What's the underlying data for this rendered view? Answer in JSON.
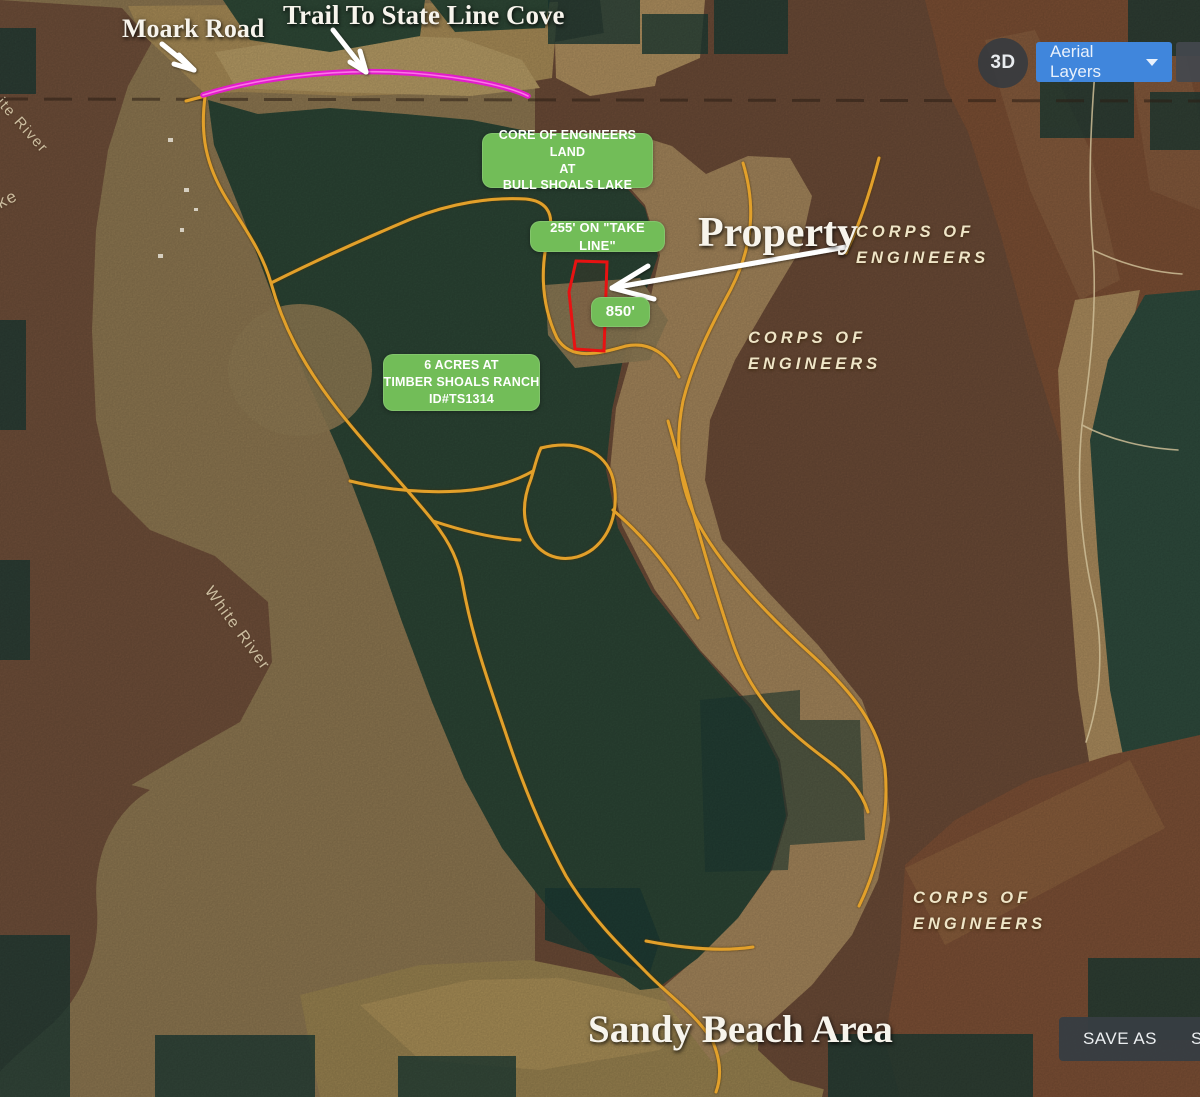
{
  "annotations": {
    "moark_road": "Moark Road",
    "trail_to_cove": "Trail To State Line Cove",
    "property": "Property",
    "sandy_beach": "Sandy Beach Area",
    "box_core": {
      "line1": "CORE OF ENGINEERS LAND",
      "line2": "AT",
      "line3": "BULL SHOALS LAKE"
    },
    "box_take_line": "255' ON \"TAKE LINE\"",
    "box_850": "850'",
    "box_acres": {
      "line1": "6 ACRES AT",
      "line2": "TIMBER SHOALS RANCH",
      "line3": "ID#TS1314"
    }
  },
  "map_labels": {
    "corps": {
      "line1": "CORPS OF",
      "line2": "ENGINEERS"
    },
    "white_river": "White River",
    "lake_partial": "ke"
  },
  "controls": {
    "three_d": "3D",
    "aerial_layers": "Aerial Layers",
    "save_as": "SAVE AS",
    "save_as_partial": "SA"
  },
  "colors": {
    "callout_green": "#72bd58",
    "trail_orange": "#e2a02a",
    "drawn_trail_magenta": "#e21ccb",
    "property_outline_red": "#e81212",
    "aerial_button_blue": "#4086dc",
    "forest_green": "#2b4434",
    "water_brown": "#6e4e39"
  }
}
